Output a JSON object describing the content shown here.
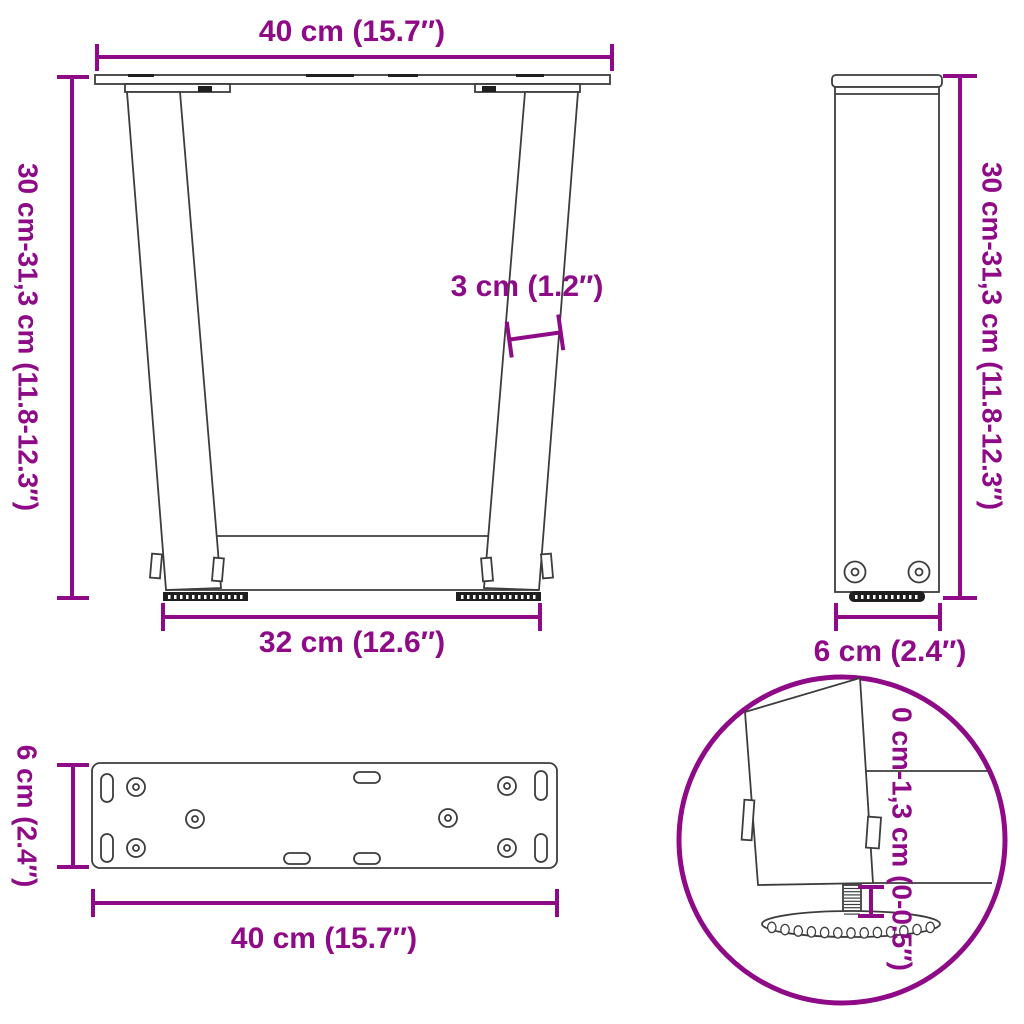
{
  "colors": {
    "accent": "#8E0A87",
    "line": "#3d3d3d",
    "dark": "#1f1f1f",
    "background": "#ffffff"
  },
  "views": {
    "front": {
      "top_width": "40 cm (15.7″)",
      "height_range": "30 cm-31,3 cm (11.8-12.3″)",
      "leg_thickness": "3 cm (1.2″)",
      "bottom_width": "32 cm (12.6″)"
    },
    "side": {
      "height_range": "30 cm-31,3 cm (11.8-12.3″)",
      "depth": "6 cm (2.4″)"
    },
    "top_plate": {
      "depth": "6 cm (2.4″)",
      "width": "40 cm (15.7″)"
    },
    "foot_detail": {
      "height_adjustment": "0 cm-1,3 cm (0-0.5″)"
    }
  }
}
